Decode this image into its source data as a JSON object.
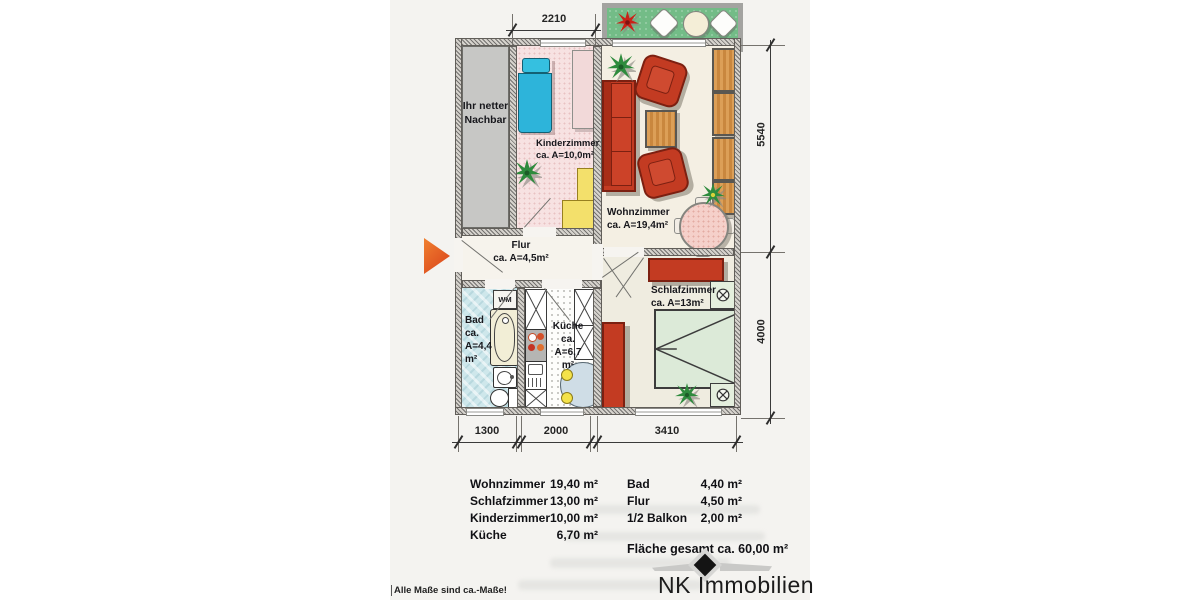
{
  "plan": {
    "dims": {
      "top": "2210",
      "right_upper": "5540",
      "right_lower": "4000",
      "bottom": [
        "1300",
        "2000",
        "3410"
      ]
    },
    "labels": {
      "neighbor": "Ihr netter\nNachbar",
      "kinderzimmer": "Kinderzimmer\nca. A=10,0m²",
      "wohnzimmer": "Wohnzimmer\nca. A=19,4m²",
      "flur": "Flur\nca. A=4,5m²",
      "bad": "Bad\nca.\nA=4,4\nm²",
      "kueche": "Küche\nca.\nA=6,7\nm²",
      "schlafzimmer": "Schlafzimmer\nca. A=13m²",
      "wm": "WM"
    }
  },
  "table": {
    "col1": [
      {
        "label": "Wohnzimmer",
        "value": "19,40 m²"
      },
      {
        "label": "Schlafzimmer",
        "value": "13,00 m²"
      },
      {
        "label": "Kinderzimmer",
        "value": "10,00 m²"
      },
      {
        "label": "Küche",
        "value": "6,70 m²"
      }
    ],
    "col2": [
      {
        "label": "Bad",
        "value": "4,40 m²"
      },
      {
        "label": "Flur",
        "value": "4,50 m²"
      },
      {
        "label": "1/2 Balkon",
        "value": "2,00 m²"
      }
    ],
    "total": "Fläche gesamt ca. 60,00 m²"
  },
  "branding": {
    "company": "NK Immobilien"
  },
  "footnote": "Alle Maße sind ca.-Maße!",
  "colors": {
    "entry_arrow": "#e2582a",
    "balcony_green": "#73bc87",
    "furniture_red": "#c33b22",
    "wood": "#d2924e",
    "bed_blue": "#2db4da",
    "closet_yellow": "#f3e06b",
    "bath_blue": "#cee7eb",
    "bed_green": "#dcead8",
    "table_pink": "#f5d0ca",
    "kinder_pink": "#f7e2e2"
  }
}
